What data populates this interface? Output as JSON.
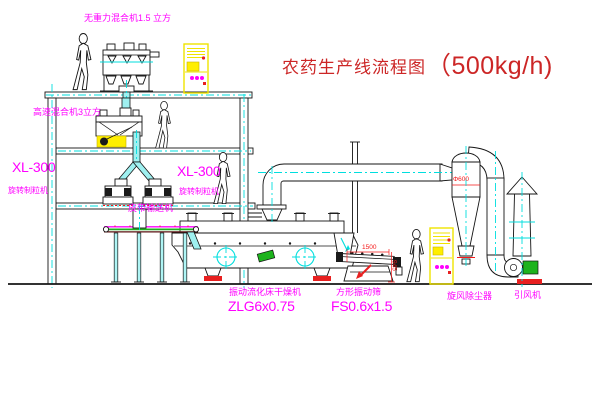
{
  "title": {
    "name": "农药生产线流程图",
    "capacity": "（500kg/h)"
  },
  "equipment": {
    "gravity_mixer": {
      "label": "无重力混合机1.5 立方"
    },
    "high_speed_mixer": {
      "label": "高速混合机3立方"
    },
    "granulator_left": {
      "model": "XL-300",
      "name": "旋转制粒机"
    },
    "granulator_right": {
      "model": "XL-300",
      "name": "旋转制粒机"
    },
    "belt_conveyor": {
      "label": "皮带输送机"
    },
    "fluid_bed_dryer": {
      "name": "振动流化床干燥机",
      "model": "ZLG6x0.75"
    },
    "vibrating_sieve": {
      "name": "方形振动筛",
      "model": "FS0.6x1.5"
    },
    "cyclone": {
      "label": "旋风除尘器"
    },
    "induced_fan": {
      "label": "引风机"
    }
  },
  "dimensions": {
    "sieve_length": "1500",
    "sieve_height": "945",
    "cyclone_note": "Φ600"
  },
  "colors": {
    "label_magenta": "#ff00ff",
    "title_red": "#cc2626",
    "dimension_red": "#f51818",
    "centerline_cyan": "#00dede",
    "cabinet_yellow": "#ffee00",
    "machine_green": "#1db31d"
  }
}
